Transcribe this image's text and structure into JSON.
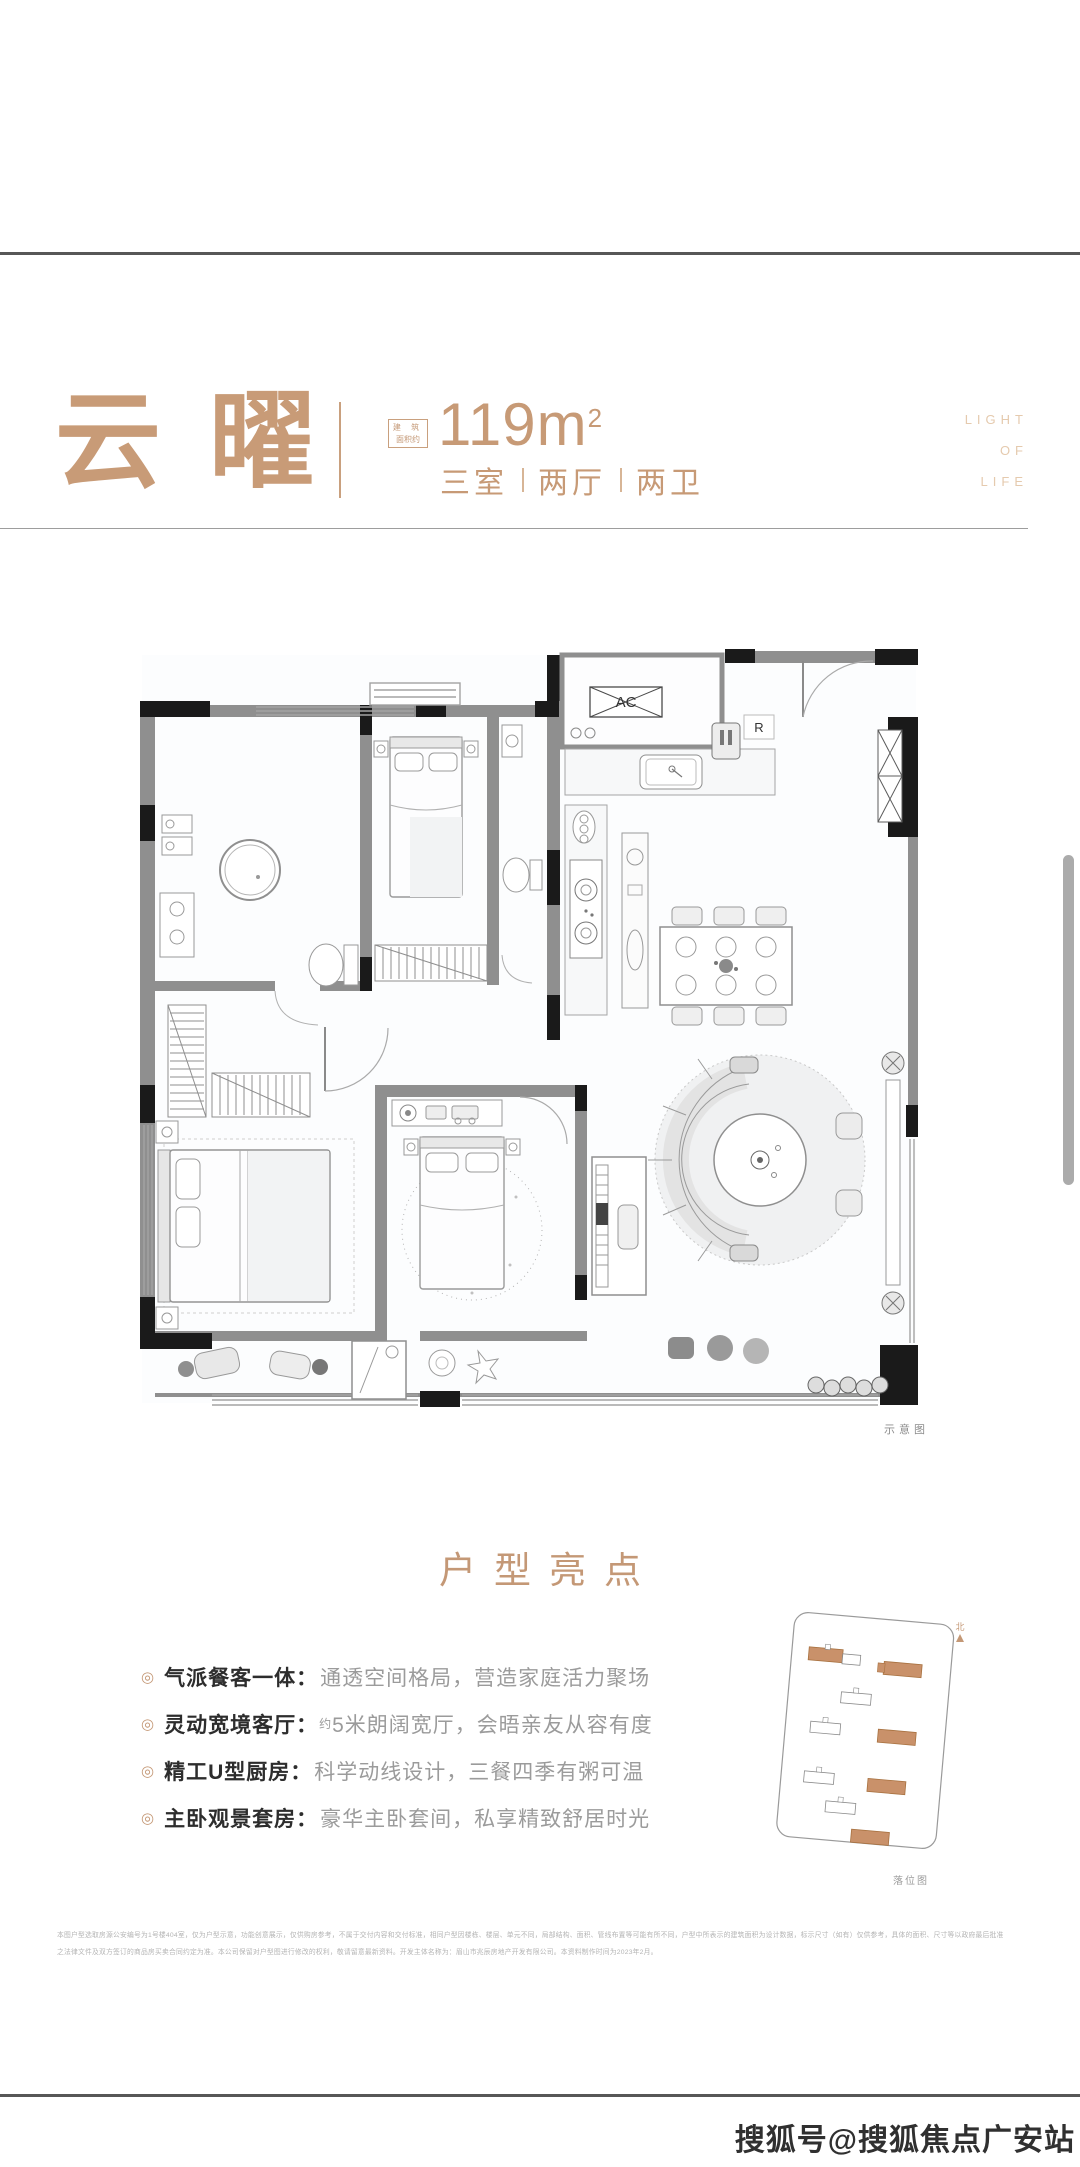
{
  "header": {
    "title": "云曜",
    "area_box_line1": "建 筑",
    "area_box_line2": "面积约",
    "area_value": "119m",
    "area_unit_sup": "2",
    "rooms": [
      "三室",
      "两厅",
      "两卫"
    ],
    "slogan": [
      "LIGHT",
      "OF",
      "LIFE"
    ]
  },
  "floorplan": {
    "ac_label": "AC",
    "fridge_label": "R",
    "caption": "示意图"
  },
  "highlights": {
    "title": "户型亮点",
    "items": [
      {
        "bullet": "◎",
        "label": "气派餐客一体：",
        "prefix": "",
        "desc": "通透空间格局，营造家庭活力聚场"
      },
      {
        "bullet": "◎",
        "label": "灵动宽境客厅：",
        "prefix": "约",
        "desc": "5米朗阔宽厅，会晤亲友从容有度"
      },
      {
        "bullet": "◎",
        "label": "精工U型厨房：",
        "prefix": "",
        "desc": "科学动线设计，三餐四季有粥可温"
      },
      {
        "bullet": "◎",
        "label": "主卧观景套房：",
        "prefix": "",
        "desc": "豪华主卧套间，私享精致舒居时光"
      }
    ]
  },
  "siteplan": {
    "compass": "北",
    "caption": "落位图"
  },
  "disclaimer": {
    "line1": "本图户型选取房源公安编号为1号楼404室，仅为户型示意，功能创意展示，仅供购房参考，不属于交付内容和交付标准，相同户型因楼栋、楼层、单元不同，局部结构、面积、管线布置等可能有所不同，户型中所表示的建筑面积为设计数据，标示尺寸（如有）仅供参考，具体的面积、尺寸等以政府最后批准",
    "line2": "之法律文件及双方签订的商品房买卖合同约定为准。本公司保留对户型图进行修改的权利，敬请留意最新资料。开发主体名称为：眉山市兆辰房地产开发有限公司。本资料制作时间为2023年2月。"
  },
  "footer": {
    "watermark": "搜狐号@搜狐焦点广安站"
  },
  "colors": {
    "accent": "#C49876",
    "accent_light": "#E5CAAE",
    "wall_black": "#1a1a1a",
    "wall_gray": "#8f8f8f"
  }
}
